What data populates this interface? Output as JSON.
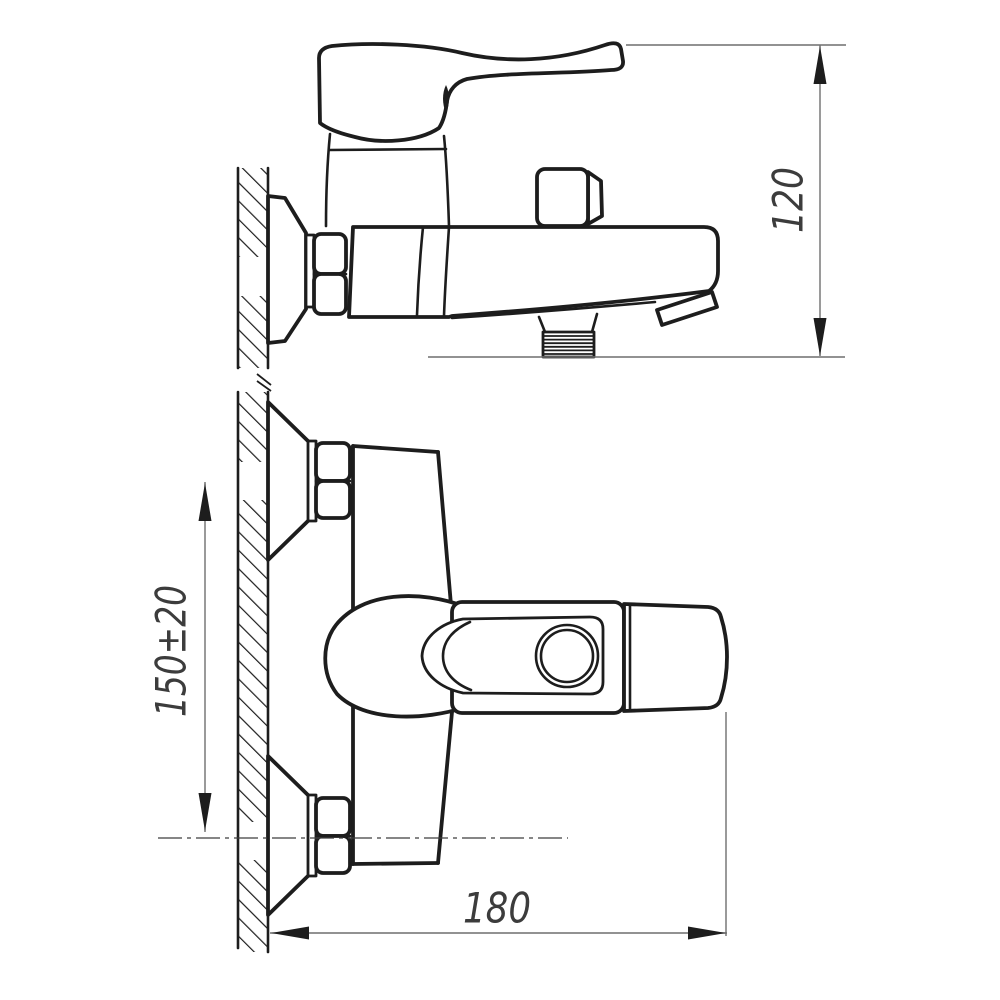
{
  "drawing": {
    "kind": "technical dimension drawing, wall-mounted bath mixer faucet, two orthographic views",
    "dimensions": {
      "height_label": "120",
      "mount_spacing_label": "150±20",
      "length_label": "180"
    },
    "colors": {
      "background": "#ffffff",
      "outline": "#1d1d1d",
      "dimension_lines": "#6f6f6f",
      "dimension_text": "#3c3c3c"
    }
  }
}
